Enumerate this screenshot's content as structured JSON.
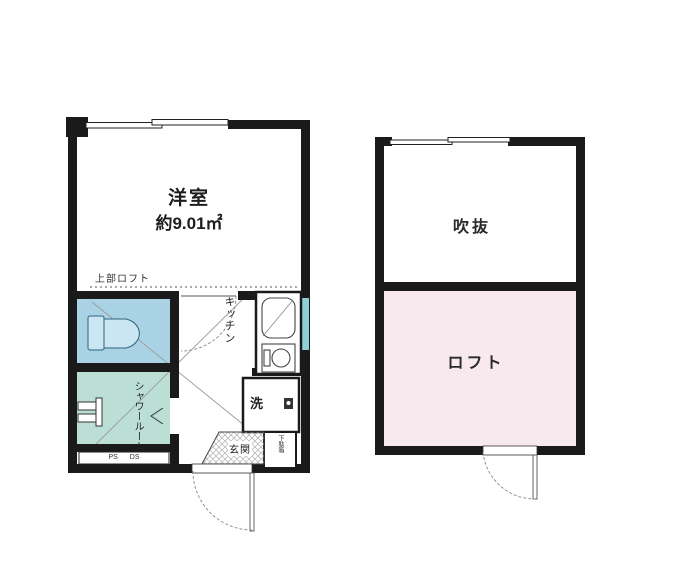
{
  "plans": {
    "first_floor": {
      "room_label": "洋室",
      "room_area": "約9.01㎡",
      "loft_above_note": "上部ロフト",
      "kitchen_label": "キッチン",
      "washer_label": "洗",
      "shower_room_label": "シャワールーム",
      "pipe_duct_label": "PS DS",
      "entrance_label": "玄関",
      "shoe_cabinet_label": "下駄箱"
    },
    "loft_floor": {
      "void_label": "吹抜",
      "loft_label": "ロフト"
    }
  },
  "colors": {
    "wall": "#1a1a1a",
    "toilet_room": "#a9d3e5",
    "shower_room": "#bcdfd5",
    "loft_room": "#f7e9ee",
    "side_window": "#8ed2d8",
    "thin_line": "#555555"
  }
}
